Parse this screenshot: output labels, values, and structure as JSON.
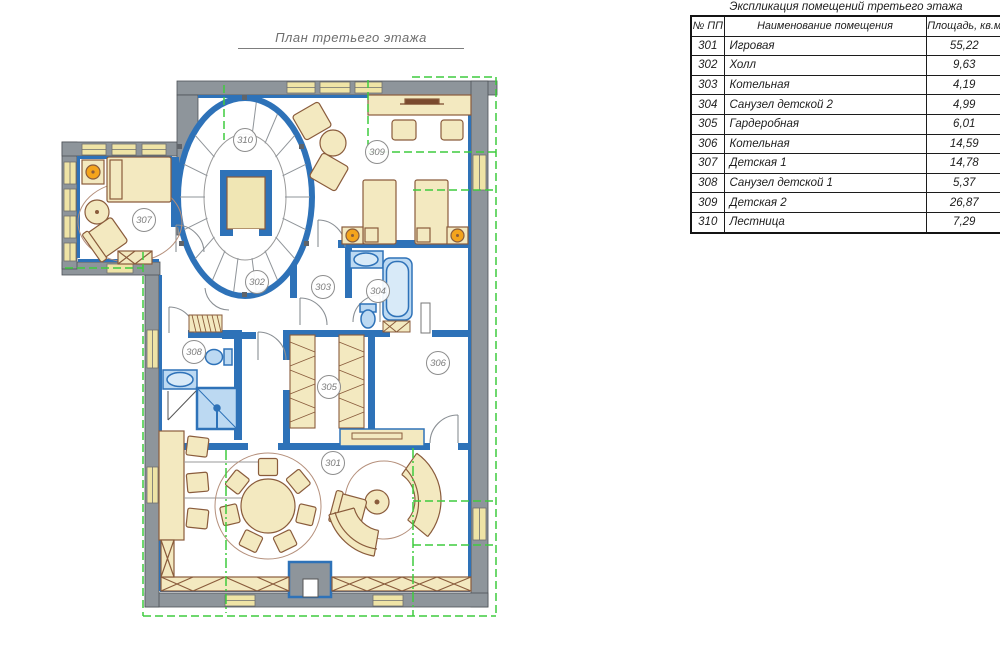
{
  "plan": {
    "title": "План третьего этажа",
    "rooms": [
      {
        "number": "301"
      },
      {
        "number": "302"
      },
      {
        "number": "303"
      },
      {
        "number": "304"
      },
      {
        "number": "305"
      },
      {
        "number": "306"
      },
      {
        "number": "307"
      },
      {
        "number": "308"
      },
      {
        "number": "309"
      },
      {
        "number": "310"
      }
    ]
  },
  "schedule": {
    "title": "Экспликация помещений третьего этажа",
    "columns": [
      "№ ПП",
      "Наименование помещения",
      "Площадь, кв.м"
    ],
    "rows": [
      {
        "no": "301",
        "name": "Игровая",
        "area": "55,22"
      },
      {
        "no": "302",
        "name": "Холл",
        "area": "9,63"
      },
      {
        "no": "303",
        "name": "Котельная",
        "area": "4,19"
      },
      {
        "no": "304",
        "name": "Санузел детской 2",
        "area": "4,99"
      },
      {
        "no": "305",
        "name": "Гардеробная",
        "area": "6,01"
      },
      {
        "no": "306",
        "name": "Котельная",
        "area": "14,59"
      },
      {
        "no": "307",
        "name": "Детская 1",
        "area": "14,78"
      },
      {
        "no": "308",
        "name": "Санузел детской 1",
        "area": "5,37"
      },
      {
        "no": "309",
        "name": "Детская 2",
        "area": "26,87"
      },
      {
        "no": "310",
        "name": "Лестница",
        "area": "7,29"
      }
    ]
  },
  "colors": {
    "wall_gray": "#8e959b",
    "wall_blue": "#2e72b8",
    "furniture_fill": "#f3e9c0",
    "furniture_stroke": "#8a5c3c",
    "fixture_fill": "#bcd9f2",
    "lamp_orange": "#f4a41c",
    "roof_line_green": "#3ecb3e",
    "window_fill": "#efe4a6"
  }
}
